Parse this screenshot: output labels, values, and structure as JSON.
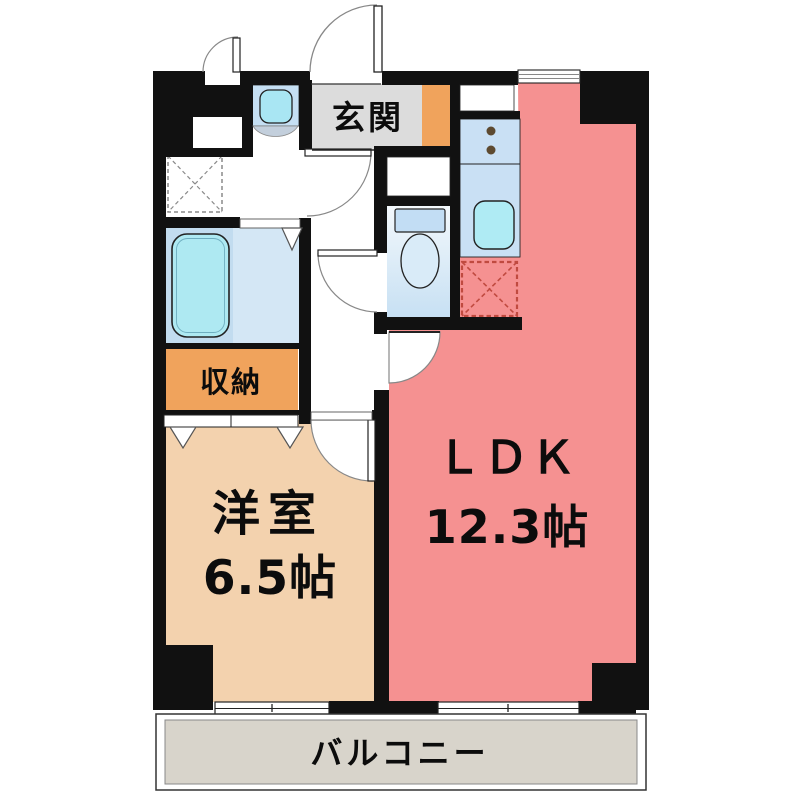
{
  "plan": {
    "type": "apartment-floorplan",
    "labels": {
      "ldk_name": "ＬＤＫ",
      "ldk_size": "12.3帖",
      "western_name": "洋室",
      "western_size": "6.5帖",
      "entrance": "玄関",
      "storage": "収納",
      "balcony": "バルコニー"
    },
    "colors": {
      "wall": "#111111",
      "ldk_floor": "#F59191",
      "western_floor": "#F3D2AE",
      "storage_orange": "#F0A35C",
      "entrance_gray": "#DCDCDC",
      "balcony_gray": "#D8D4CB",
      "bath_floor": "#C2DCEF",
      "bath_floor_light": "#D4E7F5",
      "bathtub": "#AEE9F2",
      "kitchen_counter": "#C9E0F4",
      "sink_cyan": "#AFEBF4",
      "vanity_band": "#C5DFF3",
      "vanity_bowl": "#A9E6F3",
      "toilet_tank": "#C2DDF4",
      "fridge_dash": "#C04A40",
      "washer_dash": "#8A8A8A"
    },
    "fixtures": [
      "bathtub",
      "toilet",
      "washbasin",
      "kitchen-sink",
      "gas-stove-2-burner",
      "washing-machine-space",
      "refrigerator-space"
    ],
    "doors": [
      "entrance-door",
      "meter-box-door",
      "washroom-door",
      "toilet-door",
      "ldk-door",
      "western-room-door",
      "bathroom-folding-door",
      "closet-folding-doors"
    ],
    "windows": [
      "kitchen-window",
      "balcony-window-west",
      "balcony-window-east"
    ]
  }
}
